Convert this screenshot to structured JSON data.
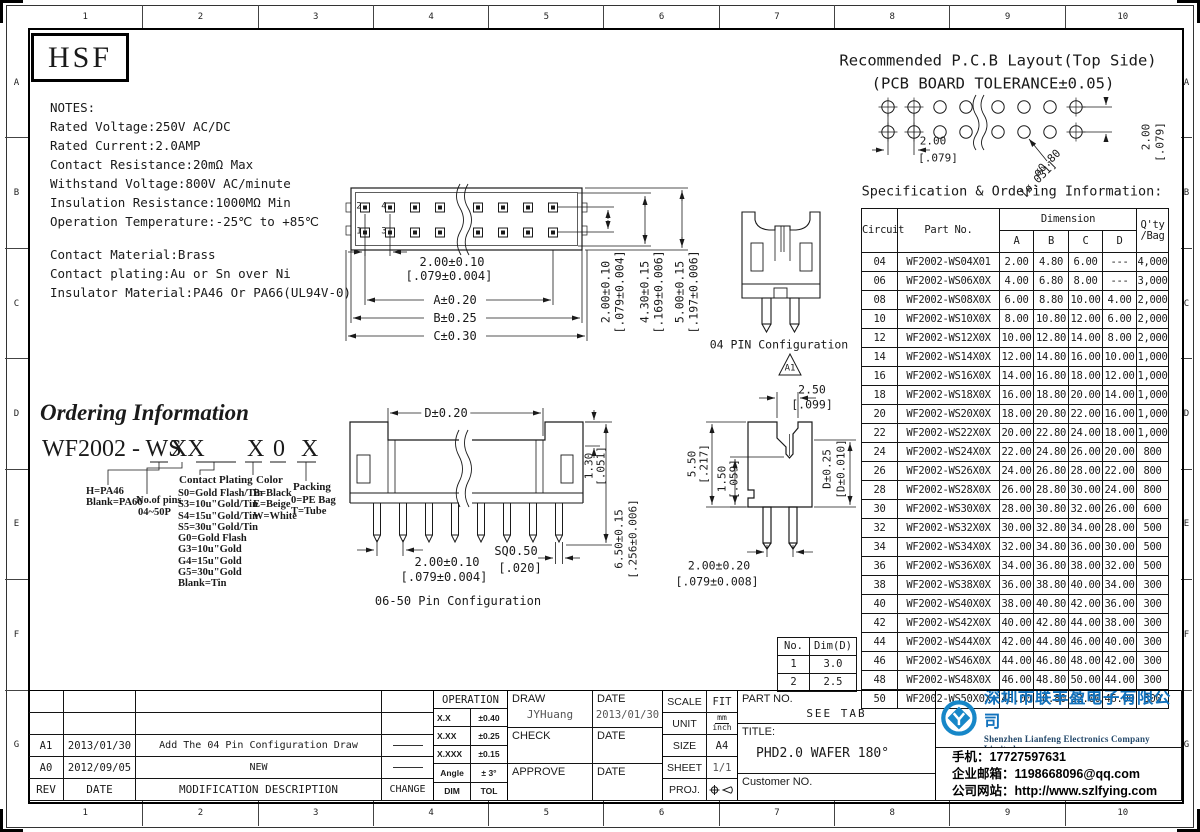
{
  "page": {
    "line_color": "#1a1a1a",
    "brand_blue": "#1272bd",
    "logo_blue": "#1787c8"
  },
  "ruler": {
    "cols": [
      "1",
      "2",
      "3",
      "4",
      "5",
      "6",
      "7",
      "8",
      "9",
      "10"
    ],
    "rows": [
      "A",
      "B",
      "C",
      "D",
      "E",
      "F",
      "G"
    ]
  },
  "logo_text": "HSF",
  "notes": {
    "title": "NOTES:",
    "lines": [
      "Rated Voltage:250V AC/DC",
      "Rated Current:2.0AMP",
      "Contact Resistance:20mΩ Max",
      "Withstand Voltage:800V AC/minute",
      "Insulation Resistance:1000MΩ Min",
      "Operation Temperature:-25℃ to +85℃"
    ],
    "material_lines": [
      "Contact Material:Brass",
      "Contact plating:Au or Sn over Ni",
      "Insulator Material:PA46 Or PA66(UL94V-0)"
    ]
  },
  "pcb": {
    "title1": "Recommended P.C.B Layout(Top Side)",
    "title2": "(PCB BOARD TOLERANCE±0.05)",
    "pitch": "2.00",
    "pitch_in": "[.079]",
    "hole": "ø0.80",
    "hole_in": "[ø.031]",
    "vpitch": "2.00",
    "vpitch_in": "[.079]"
  },
  "spec": {
    "caption": "Specification & Ordering Information:",
    "h_circuit": "Circuit",
    "h_part": "Part No.",
    "h_dim": "Dimension",
    "h_a": "A",
    "h_b": "B",
    "h_c": "C",
    "h_d": "D",
    "h_qty": "Q'ty",
    "h_bag": "/Bag",
    "rows": [
      [
        "04",
        "WF2002-WS04X01",
        "2.00",
        "4.80",
        "6.00",
        "---",
        "4,000"
      ],
      [
        "06",
        "WF2002-WS06X0X",
        "4.00",
        "6.80",
        "8.00",
        "---",
        "3,000"
      ],
      [
        "08",
        "WF2002-WS08X0X",
        "6.00",
        "8.80",
        "10.00",
        "4.00",
        "2,000"
      ],
      [
        "10",
        "WF2002-WS10X0X",
        "8.00",
        "10.80",
        "12.00",
        "6.00",
        "2,000"
      ],
      [
        "12",
        "WF2002-WS12X0X",
        "10.00",
        "12.80",
        "14.00",
        "8.00",
        "2,000"
      ],
      [
        "14",
        "WF2002-WS14X0X",
        "12.00",
        "14.80",
        "16.00",
        "10.00",
        "1,000"
      ],
      [
        "16",
        "WF2002-WS16X0X",
        "14.00",
        "16.80",
        "18.00",
        "12.00",
        "1,000"
      ],
      [
        "18",
        "WF2002-WS18X0X",
        "16.00",
        "18.80",
        "20.00",
        "14.00",
        "1,000"
      ],
      [
        "20",
        "WF2002-WS20X0X",
        "18.00",
        "20.80",
        "22.00",
        "16.00",
        "1,000"
      ],
      [
        "22",
        "WF2002-WS22X0X",
        "20.00",
        "22.80",
        "24.00",
        "18.00",
        "1,000"
      ],
      [
        "24",
        "WF2002-WS24X0X",
        "22.00",
        "24.80",
        "26.00",
        "20.00",
        "800"
      ],
      [
        "26",
        "WF2002-WS26X0X",
        "24.00",
        "26.80",
        "28.00",
        "22.00",
        "800"
      ],
      [
        "28",
        "WF2002-WS28X0X",
        "26.00",
        "28.80",
        "30.00",
        "24.00",
        "800"
      ],
      [
        "30",
        "WF2002-WS30X0X",
        "28.00",
        "30.80",
        "32.00",
        "26.00",
        "600"
      ],
      [
        "32",
        "WF2002-WS32X0X",
        "30.00",
        "32.80",
        "34.00",
        "28.00",
        "500"
      ],
      [
        "34",
        "WF2002-WS34X0X",
        "32.00",
        "34.80",
        "36.00",
        "30.00",
        "500"
      ],
      [
        "36",
        "WF2002-WS36X0X",
        "34.00",
        "36.80",
        "38.00",
        "32.00",
        "500"
      ],
      [
        "38",
        "WF2002-WS38X0X",
        "36.00",
        "38.80",
        "40.00",
        "34.00",
        "300"
      ],
      [
        "40",
        "WF2002-WS40X0X",
        "38.00",
        "40.80",
        "42.00",
        "36.00",
        "300"
      ],
      [
        "42",
        "WF2002-WS42X0X",
        "40.00",
        "42.80",
        "44.00",
        "38.00",
        "300"
      ],
      [
        "44",
        "WF2002-WS44X0X",
        "42.00",
        "44.80",
        "46.00",
        "40.00",
        "300"
      ],
      [
        "46",
        "WF2002-WS46X0X",
        "44.00",
        "46.80",
        "48.00",
        "42.00",
        "300"
      ],
      [
        "48",
        "WF2002-WS48X0X",
        "46.00",
        "48.80",
        "50.00",
        "44.00",
        "300"
      ],
      [
        "50",
        "WF2002-WS50X0X",
        "48.00",
        "50.80",
        "52.00",
        "46.00",
        "300"
      ]
    ]
  },
  "top_view": {
    "pin2": "2",
    "pin4": "4",
    "pin1": "1",
    "pin3": "3",
    "pitch": "2.00±0.10",
    "pitch_in": "[.079±0.004]",
    "dim_a": "A±0.20",
    "dim_b": "B±0.25",
    "dim_c": "C±0.30",
    "v1": "2.00±0.10",
    "v1_in": "[.079±0.004]",
    "v2": "4.30±0.15",
    "v2_in": "[.169±0.006]",
    "v3": "5.00±0.15",
    "v3_in": "[.197±0.006]"
  },
  "pin04": {
    "label": "04 PIN Configuration",
    "rev": "A1"
  },
  "ordering": {
    "heading": "Ordering Information",
    "part_prefix": "WF2002 - WS",
    "seg_pins": "XX",
    "seg_plating": "X",
    "seg_color": "0",
    "seg_packing": "X",
    "material": [
      "H=PA46",
      "Blank=PA66"
    ],
    "pins_l1": "No.of pins",
    "pins_l2": "04~50P",
    "plating_title": "Contact Plating",
    "plating": [
      "S0=Gold Flash/Tin",
      "S3=10u\"Gold/Tin",
      "S4=15u\"Gold/Tin",
      "S5=30u\"Gold/Tin",
      "G0=Gold Flash",
      "G3=10u\"Gold",
      "G4=15u\"Gold",
      "G5=30u\"Gold",
      "Blank=Tin"
    ],
    "color_title": "Color",
    "colors": [
      "B=Black",
      "E=Beige",
      "W=White"
    ],
    "packing_title": "Packing",
    "packing": [
      "0=PE Bag",
      "T=Tube"
    ]
  },
  "front_view": {
    "dim_d": "D±0.20",
    "h1": "1.30",
    "h1_in": "[.051]",
    "h2": "6.50±0.15",
    "h2_in": "[.256±0.006]",
    "pitch": "2.00±0.10",
    "pitch_in": "[.079±0.004]",
    "sq": "SQ0.50",
    "sq_in": "[.020]",
    "label": "06-50 Pin Configuration"
  },
  "side_view": {
    "w": "2.50",
    "w_in": "[.099]",
    "h1": "5.50",
    "h1_in": "[.217]",
    "h2": "1.50",
    "h2_in": "[.059]",
    "d": "D±0.25",
    "d_in": "[D±0.010]",
    "pitch": "2.00±0.20",
    "pitch_in": "[.079±0.008]"
  },
  "dim_table": {
    "h_no": "No.",
    "h_dim": "Dim(D)",
    "rows": [
      [
        "1",
        "3.0"
      ],
      [
        "2",
        "2.5"
      ]
    ]
  },
  "tb": {
    "rev_rows": [
      {
        "rev": "A1",
        "date": "2013/01/30",
        "desc": "Add The 04 Pin Configuration Draw"
      },
      {
        "rev": "A0",
        "date": "2012/09/05",
        "desc": "NEW"
      }
    ],
    "h_rev": "REV",
    "h_date": "DATE",
    "h_desc": "MODIFICATION DESCRIPTION",
    "h_chg": "CHANGE",
    "op_title": "OPERATION",
    "op_rows": [
      [
        "X.X",
        "±0.40"
      ],
      [
        "X.XX",
        "±0.25"
      ],
      [
        "X.XXX",
        "±0.15"
      ],
      [
        "Angle",
        "± 3°"
      ],
      [
        "DIM",
        "TOL"
      ]
    ],
    "draw": "DRAW",
    "draw_name": "JYHuang",
    "date": "DATE",
    "draw_date": "2013/01/30",
    "check": "CHECK",
    "approve": "APPROVE",
    "scale": "SCALE",
    "scale_v": "FIT",
    "unit": "UNIT",
    "unit_mm": "mm",
    "unit_inch": "inch",
    "size": "SIZE",
    "size_v": "A4",
    "sheet": "SHEET",
    "sheet_v": "1/1",
    "proj": "PROJ.",
    "part_no": "PART NO.",
    "part_no_v": "SEE TAB",
    "title": "TITLE:",
    "title_v": "PHD2.0 WAFER 180°",
    "customer": "Customer NO."
  },
  "company": {
    "cn": "深圳市联丰盈电子有限公司",
    "en": "Shenzhen Lianfeng Electronics Company Limited",
    "phone": "手机：17727597631",
    "email": "企业邮箱：1198668096@qq.com",
    "web": "公司网站：http://www.szlfying.com"
  }
}
